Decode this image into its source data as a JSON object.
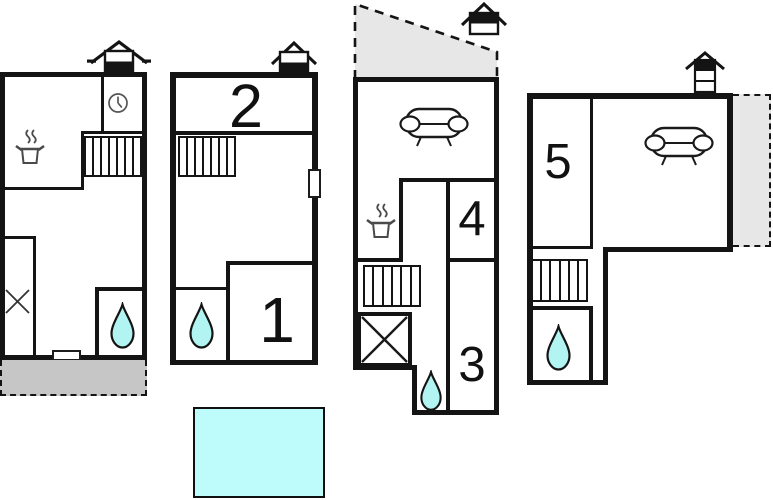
{
  "labels": {
    "room1": "1",
    "room2": "2",
    "room3": "3",
    "room4": "4",
    "room5": "5"
  },
  "colors": {
    "wall": "#141414",
    "water-fill": "#b2f4f2",
    "pool-fill": "#bdfcfa",
    "terrace-fill": "#c6c6c6",
    "annex-fill": "#e7e7e7",
    "icon-stroke": "#4a4a4a"
  },
  "units": [
    {
      "id": "unit-1",
      "features": [
        "chimney-icon",
        "clock-icon",
        "stove-icon",
        "stairs",
        "cross-mark",
        "water-drop-icon",
        "door",
        "terrace"
      ]
    },
    {
      "id": "unit-2",
      "features": [
        "chimney-icon",
        "stairs",
        "water-drop-icon",
        "door",
        "room-2",
        "room-1"
      ]
    },
    {
      "id": "unit-3",
      "features": [
        "chimney-icon",
        "sofa-icon",
        "stove-icon",
        "stairs",
        "washer-cross-box",
        "water-drop-icon",
        "room-4",
        "room-3",
        "dashed-annex"
      ]
    },
    {
      "id": "unit-4",
      "features": [
        "chimney-icon",
        "sofa-icon",
        "stairs",
        "water-drop-icon",
        "room-5",
        "dashed-annex"
      ]
    }
  ],
  "pool": {
    "shape": "rectangle"
  }
}
